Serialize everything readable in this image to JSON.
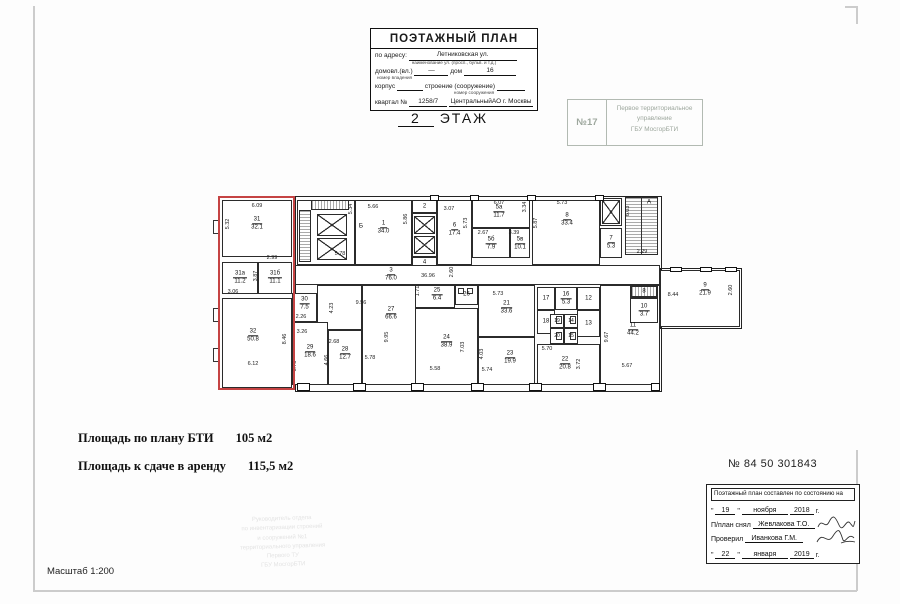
{
  "header_stamp": {
    "title": "ПОЭТАЖНЫЙ ПЛАН",
    "address_label": "по адресу:",
    "address_value": "Летниковская ул.",
    "address_hint": "наименование ул. (просп., бульв. и т.д.)",
    "homestead_label": "домовл.(вл.)",
    "homestead_value": "—",
    "house_label": "дом",
    "house_value": "16",
    "homestead_hint": "номер владения",
    "building_label": "корпус",
    "structure_label": "строение (сооружение)",
    "structure_hint": "номер сооружения",
    "quarter_label": "квартал №",
    "quarter_value": "1258/7",
    "district_value": "ЦентральныйАО г. Москвы"
  },
  "floor_title": {
    "number": "2",
    "label": "ЭТАЖ"
  },
  "bti_stamp": {
    "number": "№17",
    "lines": [
      "Первое территориальное",
      "управление",
      "ГБУ МосгорБТИ"
    ]
  },
  "areas": {
    "bti_label": "Площадь по плану БТИ",
    "bti_value": "105 м2",
    "rent_label": "Площадь к сдаче в аренду",
    "rent_value": "115,5 м2"
  },
  "doc_number": "№ 84 50 301843",
  "scale": "Масштаб 1:200",
  "approval": {
    "title": "Поэтажный план составлен по состоянию на",
    "q1": "\"",
    "q2": "\"",
    "date1_day": "19",
    "date1_month": "ноября",
    "date1_year": "2018",
    "year_suffix": "г.",
    "surveyor_label": "П/план снял",
    "surveyor_name": "Жевлакова Т.О.",
    "checker_label": "Проверил",
    "checker_name": "Иванкова Г.М.",
    "date2_day": "22",
    "date2_month": "января",
    "date2_year": "2019"
  },
  "faint": {
    "lines": [
      "Руководитель отдела",
      "по инвентаризации строений",
      "и сооружений №1",
      "территориального управления",
      "Первого ТУ",
      "ГБУ МосгорБТИ"
    ]
  },
  "plan": {
    "highlight": {
      "x": 3,
      "y": 4,
      "w": 77,
      "h": 194,
      "color": "#c54343"
    },
    "outlines": [
      {
        "x": 80,
        "y": 4,
        "w": 365,
        "h": 194
      },
      {
        "x": 445,
        "y": 76,
        "w": 80,
        "h": 59
      }
    ],
    "rooms": [
      {
        "n": "31",
        "a": "32.1",
        "x": 7,
        "y": 8,
        "w": 70,
        "h": 57,
        "ly": 32
      },
      {
        "n": "31а",
        "a": "11.2",
        "x": 7,
        "y": 70,
        "w": 36,
        "h": 32
      },
      {
        "n": "31б",
        "a": "11.1",
        "x": 43,
        "y": 70,
        "w": 34,
        "h": 32
      },
      {
        "n": "32",
        "a": "50.8",
        "x": 7,
        "y": 106,
        "w": 70,
        "h": 90,
        "lx": 38,
        "ly": 144
      },
      {
        "n": "",
        "x": 82,
        "y": 8,
        "w": 58,
        "h": 65
      },
      {
        "n": "1",
        "a": "34.0",
        "x": 140,
        "y": 8,
        "w": 57,
        "h": 65,
        "ly": 36
      },
      {
        "n": "2",
        "x": 197,
        "y": 8,
        "w": 25,
        "h": 13
      },
      {
        "n": "",
        "x": 197,
        "y": 21,
        "w": 25,
        "h": 44
      },
      {
        "n": "4",
        "x": 197,
        "y": 65,
        "w": 25,
        "h": 12
      },
      {
        "n": "6",
        "a": "17.4",
        "x": 222,
        "y": 8,
        "w": 35,
        "h": 65,
        "ly": 38
      },
      {
        "n": "5а",
        "a": "11.7",
        "x": 257,
        "y": 8,
        "w": 58,
        "h": 28,
        "lx": 284,
        "ly": 20
      },
      {
        "n": "5б",
        "a": "7.9",
        "x": 257,
        "y": 36,
        "w": 38,
        "h": 30,
        "ly": 52
      },
      {
        "n": "5в",
        "a": "10.1",
        "x": 295,
        "y": 36,
        "w": 20,
        "h": 30,
        "ly": 52
      },
      {
        "n": "8",
        "a": "33.4",
        "x": 317,
        "y": 8,
        "w": 68,
        "h": 65,
        "lx": 352,
        "ly": 28
      },
      {
        "n": "",
        "x": 385,
        "y": 6,
        "w": 22,
        "h": 28
      },
      {
        "n": "7",
        "a": "5.3",
        "x": 385,
        "y": 36,
        "w": 22,
        "h": 30
      },
      {
        "n": "3",
        "a": "76.0",
        "x": 80,
        "y": 73,
        "w": 365,
        "h": 20,
        "lx": 176,
        "ly": 83
      },
      {
        "n": "30",
        "a": "7.5",
        "x": 77,
        "y": 101,
        "w": 25,
        "h": 29,
        "ly": 112
      },
      {
        "n": "",
        "x": 102,
        "y": 93,
        "w": 45,
        "h": 45
      },
      {
        "n": "29",
        "a": "18.6",
        "x": 77,
        "y": 130,
        "w": 36,
        "h": 63,
        "ly": 160
      },
      {
        "n": "28",
        "a": "12.7",
        "x": 113,
        "y": 138,
        "w": 34,
        "h": 55,
        "ly": 162
      },
      {
        "n": "27",
        "a": "66.6",
        "x": 147,
        "y": 93,
        "w": 58,
        "h": 100,
        "ly": 122
      },
      {
        "n": "25",
        "a": "6.4",
        "x": 200,
        "y": 93,
        "w": 40,
        "h": 23,
        "lx": 222,
        "ly": 103
      },
      {
        "n": "26",
        "x": 240,
        "y": 93,
        "w": 23,
        "h": 20
      },
      {
        "n": "24",
        "a": "38.9",
        "x": 200,
        "y": 116,
        "w": 63,
        "h": 77,
        "ly": 150
      },
      {
        "n": "21",
        "a": "33.6",
        "x": 263,
        "y": 93,
        "w": 57,
        "h": 52,
        "ly": 116
      },
      {
        "n": "23",
        "a": "19.9",
        "x": 263,
        "y": 145,
        "w": 57,
        "h": 48,
        "lx": 295,
        "ly": 166
      },
      {
        "n": "17",
        "x": 322,
        "y": 95,
        "w": 18,
        "h": 23
      },
      {
        "n": "16",
        "a": "5.3",
        "x": 340,
        "y": 95,
        "w": 22,
        "h": 23
      },
      {
        "n": "12",
        "x": 362,
        "y": 95,
        "w": 23,
        "h": 23
      },
      {
        "n": "18",
        "x": 322,
        "y": 118,
        "w": 18,
        "h": 24
      },
      {
        "n": "13",
        "x": 362,
        "y": 118,
        "w": 23,
        "h": 27
      },
      {
        "n": "19",
        "x": 335,
        "y": 122,
        "w": 14,
        "h": 14
      },
      {
        "n": "14",
        "x": 349,
        "y": 122,
        "w": 14,
        "h": 14
      },
      {
        "n": "20",
        "x": 335,
        "y": 136,
        "w": 14,
        "h": 16
      },
      {
        "n": "15",
        "x": 349,
        "y": 136,
        "w": 14,
        "h": 16
      },
      {
        "n": "22",
        "a": "20.8",
        "x": 322,
        "y": 152,
        "w": 63,
        "h": 41,
        "lx": 350,
        "ly": 172
      },
      {
        "n": "11",
        "a": "44.2",
        "x": 385,
        "y": 93,
        "w": 60,
        "h": 100,
        "lx": 418,
        "ly": 138
      },
      {
        "n": "8",
        "x": 415,
        "y": 93,
        "w": 28,
        "h": 13
      },
      {
        "n": "10",
        "a": "3.7",
        "x": 415,
        "y": 106,
        "w": 28,
        "h": 25
      },
      {
        "n": "9",
        "a": "21.9",
        "x": 445,
        "y": 78,
        "w": 80,
        "h": 57,
        "lx": 490,
        "ly": 98
      }
    ],
    "dims": [
      {
        "v": "6.09",
        "x": 42,
        "y": 14
      },
      {
        "v": "5.32",
        "x": 13,
        "y": 32,
        "r": 1
      },
      {
        "v": "2.99",
        "x": 57,
        "y": 66
      },
      {
        "v": "3.87",
        "x": 41,
        "y": 84,
        "r": 1
      },
      {
        "v": "3.06",
        "x": 18,
        "y": 100
      },
      {
        "v": "8.46",
        "x": 70,
        "y": 147,
        "r": 1
      },
      {
        "v": "6.12",
        "x": 38,
        "y": 172
      },
      {
        "v": "5.34",
        "x": 136,
        "y": 17,
        "r": 1
      },
      {
        "v": "5.78",
        "x": 125,
        "y": 62
      },
      {
        "v": "5.66",
        "x": 158,
        "y": 15
      },
      {
        "v": "5.86",
        "x": 191,
        "y": 27,
        "r": 1
      },
      {
        "v": "3.07",
        "x": 234,
        "y": 17
      },
      {
        "v": "5.73",
        "x": 251,
        "y": 31,
        "r": 1
      },
      {
        "v": "6.07",
        "x": 284,
        "y": 11
      },
      {
        "v": "3.34",
        "x": 310,
        "y": 15,
        "r": 1
      },
      {
        "v": "2.67",
        "x": 268,
        "y": 41
      },
      {
        "v": "3.39",
        "x": 299,
        "y": 41
      },
      {
        "v": "5.73",
        "x": 347,
        "y": 11
      },
      {
        "v": "5.87",
        "x": 321,
        "y": 31,
        "r": 1
      },
      {
        "v": "6.03",
        "x": 413,
        "y": 19,
        "r": 1
      },
      {
        "v": "2.29",
        "x": 427,
        "y": 60
      },
      {
        "v": "36.96",
        "x": 213,
        "y": 84
      },
      {
        "v": "2.60",
        "x": 237,
        "y": 80,
        "r": 1
      },
      {
        "v": "2.26",
        "x": 86,
        "y": 125
      },
      {
        "v": "4.23",
        "x": 117,
        "y": 116,
        "r": 1
      },
      {
        "v": "9.56",
        "x": 146,
        "y": 111
      },
      {
        "v": "3.26",
        "x": 87,
        "y": 140
      },
      {
        "v": "5.75",
        "x": 80,
        "y": 174,
        "r": 1
      },
      {
        "v": "2.68",
        "x": 119,
        "y": 150
      },
      {
        "v": "4.66",
        "x": 112,
        "y": 168,
        "r": 1
      },
      {
        "v": "9.95",
        "x": 172,
        "y": 145,
        "r": 1
      },
      {
        "v": "5.78",
        "x": 155,
        "y": 166
      },
      {
        "v": "1.71",
        "x": 203,
        "y": 99,
        "r": 1
      },
      {
        "v": "7.03",
        "x": 248,
        "y": 155,
        "r": 1
      },
      {
        "v": "5.58",
        "x": 220,
        "y": 177
      },
      {
        "v": "5.73",
        "x": 283,
        "y": 102
      },
      {
        "v": "4.03",
        "x": 267,
        "y": 162,
        "r": 1
      },
      {
        "v": "5.74",
        "x": 272,
        "y": 178
      },
      {
        "v": "5.70",
        "x": 332,
        "y": 157
      },
      {
        "v": "3.72",
        "x": 364,
        "y": 172,
        "r": 1
      },
      {
        "v": "9.67",
        "x": 392,
        "y": 145,
        "r": 1
      },
      {
        "v": "5.67",
        "x": 412,
        "y": 174
      },
      {
        "v": "8.44",
        "x": 458,
        "y": 103
      },
      {
        "v": "2.60",
        "x": 516,
        "y": 98,
        "r": 1
      }
    ],
    "lifts": [
      {
        "x": 102,
        "y": 22,
        "w": 30,
        "h": 22
      },
      {
        "x": 102,
        "y": 46,
        "w": 30,
        "h": 22
      },
      {
        "x": 199,
        "y": 24,
        "w": 21,
        "h": 18
      },
      {
        "x": 199,
        "y": 44,
        "w": 21,
        "h": 18
      },
      {
        "x": 387,
        "y": 8,
        "w": 18,
        "h": 24
      }
    ],
    "hatches": [
      {
        "t": "h",
        "x": 84,
        "y": 18,
        "w": 12,
        "h": 52
      },
      {
        "t": "v",
        "x": 96,
        "y": 8,
        "w": 38,
        "h": 10
      },
      {
        "t": "h",
        "x": 410,
        "y": 5,
        "w": 33,
        "h": 58
      },
      {
        "t": "v",
        "x": 416,
        "y": 94,
        "w": 26,
        "h": 11
      }
    ],
    "lines": [
      {
        "x": 426,
        "y": 5,
        "w": 1,
        "h": 58
      }
    ],
    "piers": [
      {
        "x": 82,
        "y": 191,
        "w": 13,
        "h": 8
      },
      {
        "x": 138,
        "y": 191,
        "w": 13,
        "h": 8
      },
      {
        "x": 196,
        "y": 191,
        "w": 13,
        "h": 8
      },
      {
        "x": 256,
        "y": 191,
        "w": 13,
        "h": 8
      },
      {
        "x": 314,
        "y": 191,
        "w": 13,
        "h": 8
      },
      {
        "x": 378,
        "y": 191,
        "w": 13,
        "h": 8
      },
      {
        "x": 436,
        "y": 191,
        "w": 9,
        "h": 8
      },
      {
        "x": 215,
        "y": 3,
        "w": 9,
        "h": 6
      },
      {
        "x": 255,
        "y": 3,
        "w": 9,
        "h": 6
      },
      {
        "x": 312,
        "y": 3,
        "w": 9,
        "h": 6
      },
      {
        "x": 380,
        "y": 3,
        "w": 9,
        "h": 6
      },
      {
        "x": 455,
        "y": 75,
        "w": 12,
        "h": 5
      },
      {
        "x": 485,
        "y": 75,
        "w": 12,
        "h": 5
      },
      {
        "x": 510,
        "y": 75,
        "w": 12,
        "h": 5
      }
    ],
    "windows": [
      {
        "x": -2,
        "y": 28,
        "w": 7,
        "h": 14
      },
      {
        "x": -2,
        "y": 116,
        "w": 7,
        "h": 14
      },
      {
        "x": -2,
        "y": 156,
        "w": 7,
        "h": 14
      }
    ],
    "fixtures": [
      {
        "x": 341,
        "y": 124,
        "w": 6,
        "h": 8
      },
      {
        "x": 355,
        "y": 124,
        "w": 6,
        "h": 8
      },
      {
        "x": 341,
        "y": 140,
        "w": 6,
        "h": 8
      },
      {
        "x": 355,
        "y": 140,
        "w": 6,
        "h": 8
      },
      {
        "x": 243,
        "y": 96,
        "w": 6,
        "h": 6
      },
      {
        "x": 252,
        "y": 96,
        "w": 6,
        "h": 6
      }
    ],
    "labels": [
      {
        "t": "Б",
        "x": 146,
        "y": 34
      },
      {
        "t": "А",
        "x": 434,
        "y": 10
      }
    ]
  }
}
